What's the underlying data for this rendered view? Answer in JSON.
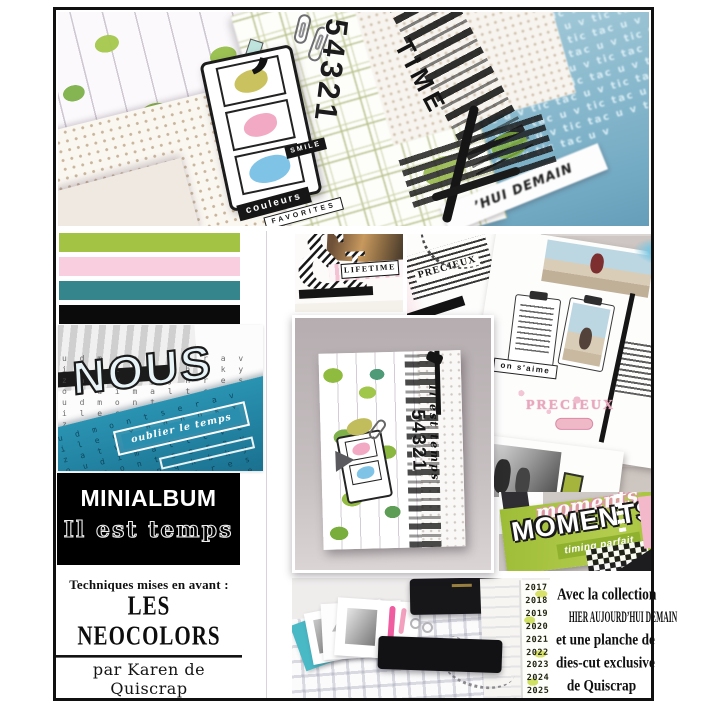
{
  "palette": {
    "swatches": [
      {
        "name": "green",
        "hex": "#a2c344"
      },
      {
        "name": "pink",
        "hex": "#f9cede"
      },
      {
        "name": "teal",
        "hex": "#35868c"
      },
      {
        "name": "black",
        "hex": "#0b0b0b"
      }
    ]
  },
  "left_column": {
    "minialbum": {
      "title": "MINIALBUM",
      "subtitle": "Il est temps"
    },
    "techniques_label": "Techniques mises en avant :",
    "technique_name": "LES NEOCOLORS",
    "author": "par Karen de Quiscrap"
  },
  "top_photo": {
    "numbers": "54321",
    "time_stamp": "TIME",
    "chip_primary": "couleurs",
    "chip_secondary": "FAVORITES",
    "chip_smile": "SMILE",
    "strip_text": "’HUI DEMAIN",
    "tictac_text": "tic tac u v "
  },
  "collage": {
    "nous": {
      "title": "NOUS",
      "chip": "oublier le temps",
      "letters": "u d m o n t s e r a v i l e c x p q h b k y z a t w f g j n r e s o u d i m a l t c v e "
    },
    "ampersand": {
      "glyph": "&",
      "label": "LIFETIME"
    },
    "cards": {
      "stamp_word": "PRECIEUX",
      "chip": "on s'aime",
      "stamp_pink": "PRECIEUX"
    },
    "album_cover": {
      "numbers": "54321",
      "script": "Il est temps"
    },
    "moments": {
      "script": "moments",
      "caps": "MOMENTS",
      "chip": "timing parfait"
    },
    "open_album": {
      "years": [
        "2017",
        "2018",
        "2019",
        "2020",
        "2021",
        "2022",
        "2023",
        "2024",
        "2025"
      ]
    }
  },
  "footer": {
    "lines": [
      "Avec la collection",
      "HIER AUJOURD’HUI DEMAIN",
      "et une planche de",
      "dies-cut exclusive",
      "de Quiscrap"
    ]
  }
}
